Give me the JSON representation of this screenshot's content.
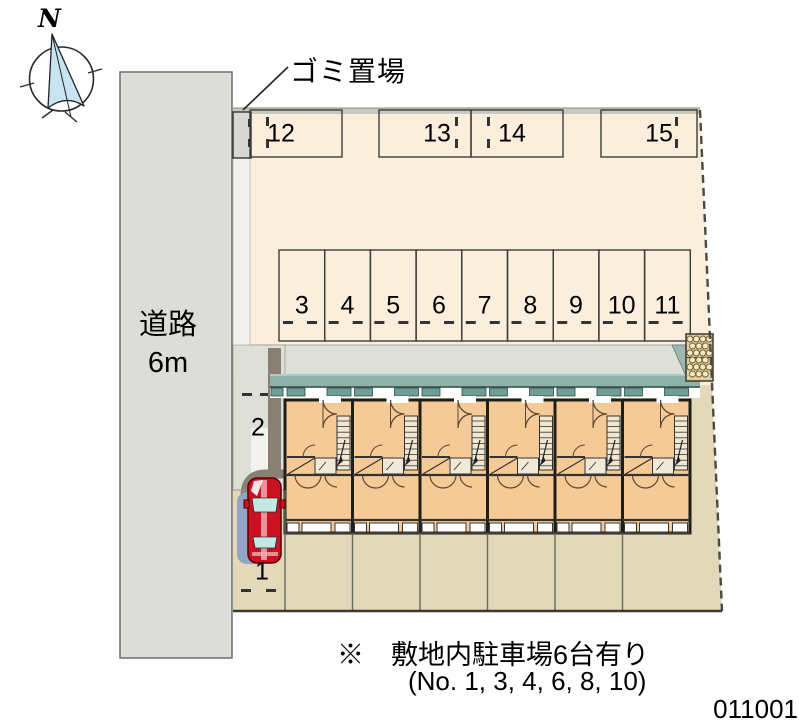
{
  "compass": {
    "north_label": "N"
  },
  "road": {
    "name": "道路",
    "width": "6m"
  },
  "garbage_area": {
    "label": "ゴミ置場"
  },
  "parking": {
    "top_row_numbers": [
      "12",
      "13",
      "14",
      "15"
    ],
    "middle_row_numbers": [
      "3",
      "4",
      "5",
      "6",
      "7",
      "8",
      "9",
      "10",
      "11"
    ],
    "side_numbers": [
      "1",
      "2"
    ]
  },
  "building": {
    "unit_count": 6
  },
  "vehicle": {
    "type": "red-car"
  },
  "note": {
    "line1": "※　敷地内駐車場6台有り",
    "line2": "(No. 1, 3, 4, 6, 8, 10)"
  },
  "plan_id": "011001",
  "colors": {
    "road_gray": "#DCDCD8",
    "site_peach": "#FBEEDD",
    "ground_tan": "#E3D8B9",
    "building_orange": "#F6CA97",
    "eave_teal": "#8FB3AB",
    "tile_teal": "#6E9E96",
    "curb_brown": "#8A7F75",
    "car_red": "#CC1122",
    "car_shadow_blue": "#94A3C8"
  }
}
